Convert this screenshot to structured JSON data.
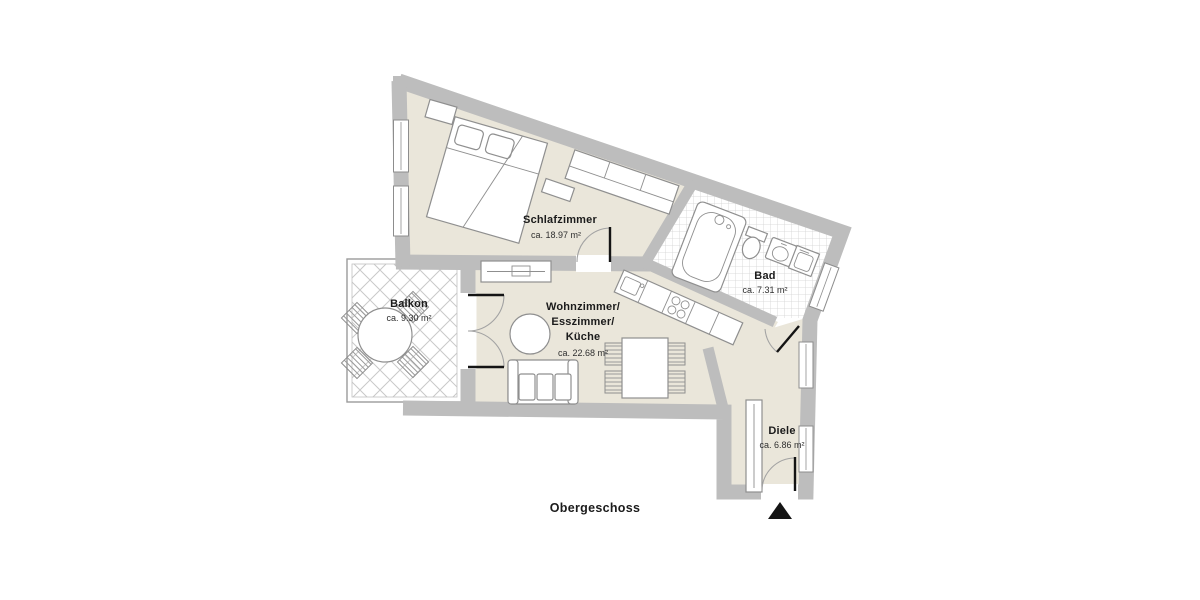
{
  "floor_plan": {
    "floor_label": "Obergeschoss",
    "rooms": {
      "schlafzimmer": {
        "name": "Schlafzimmer",
        "area": "ca. 18.97 m²"
      },
      "bad": {
        "name": "Bad",
        "area": "ca. 7.31 m²"
      },
      "balkon": {
        "name": "Balkon",
        "area": "ca. 9.30 m²"
      },
      "wohnzimmer": {
        "name_line1": "Wohnzimmer/",
        "name_line2": "Esszimmer/",
        "name_line3": "Küche",
        "area": "ca. 22.68 m²"
      },
      "diele": {
        "name": "Diele",
        "area": "ca. 6.86 m²"
      }
    },
    "colors": {
      "wall": "#bdbdbd",
      "floor": "#eae6da",
      "tile_line": "#d2d2d2",
      "furniture_stroke": "#8f8f8f",
      "label_text": "#1b1b1b",
      "door_leaf": "#141414",
      "entrance_marker": "#141414"
    },
    "markers": {
      "entrance": "entrance-arrow-triangle"
    }
  }
}
